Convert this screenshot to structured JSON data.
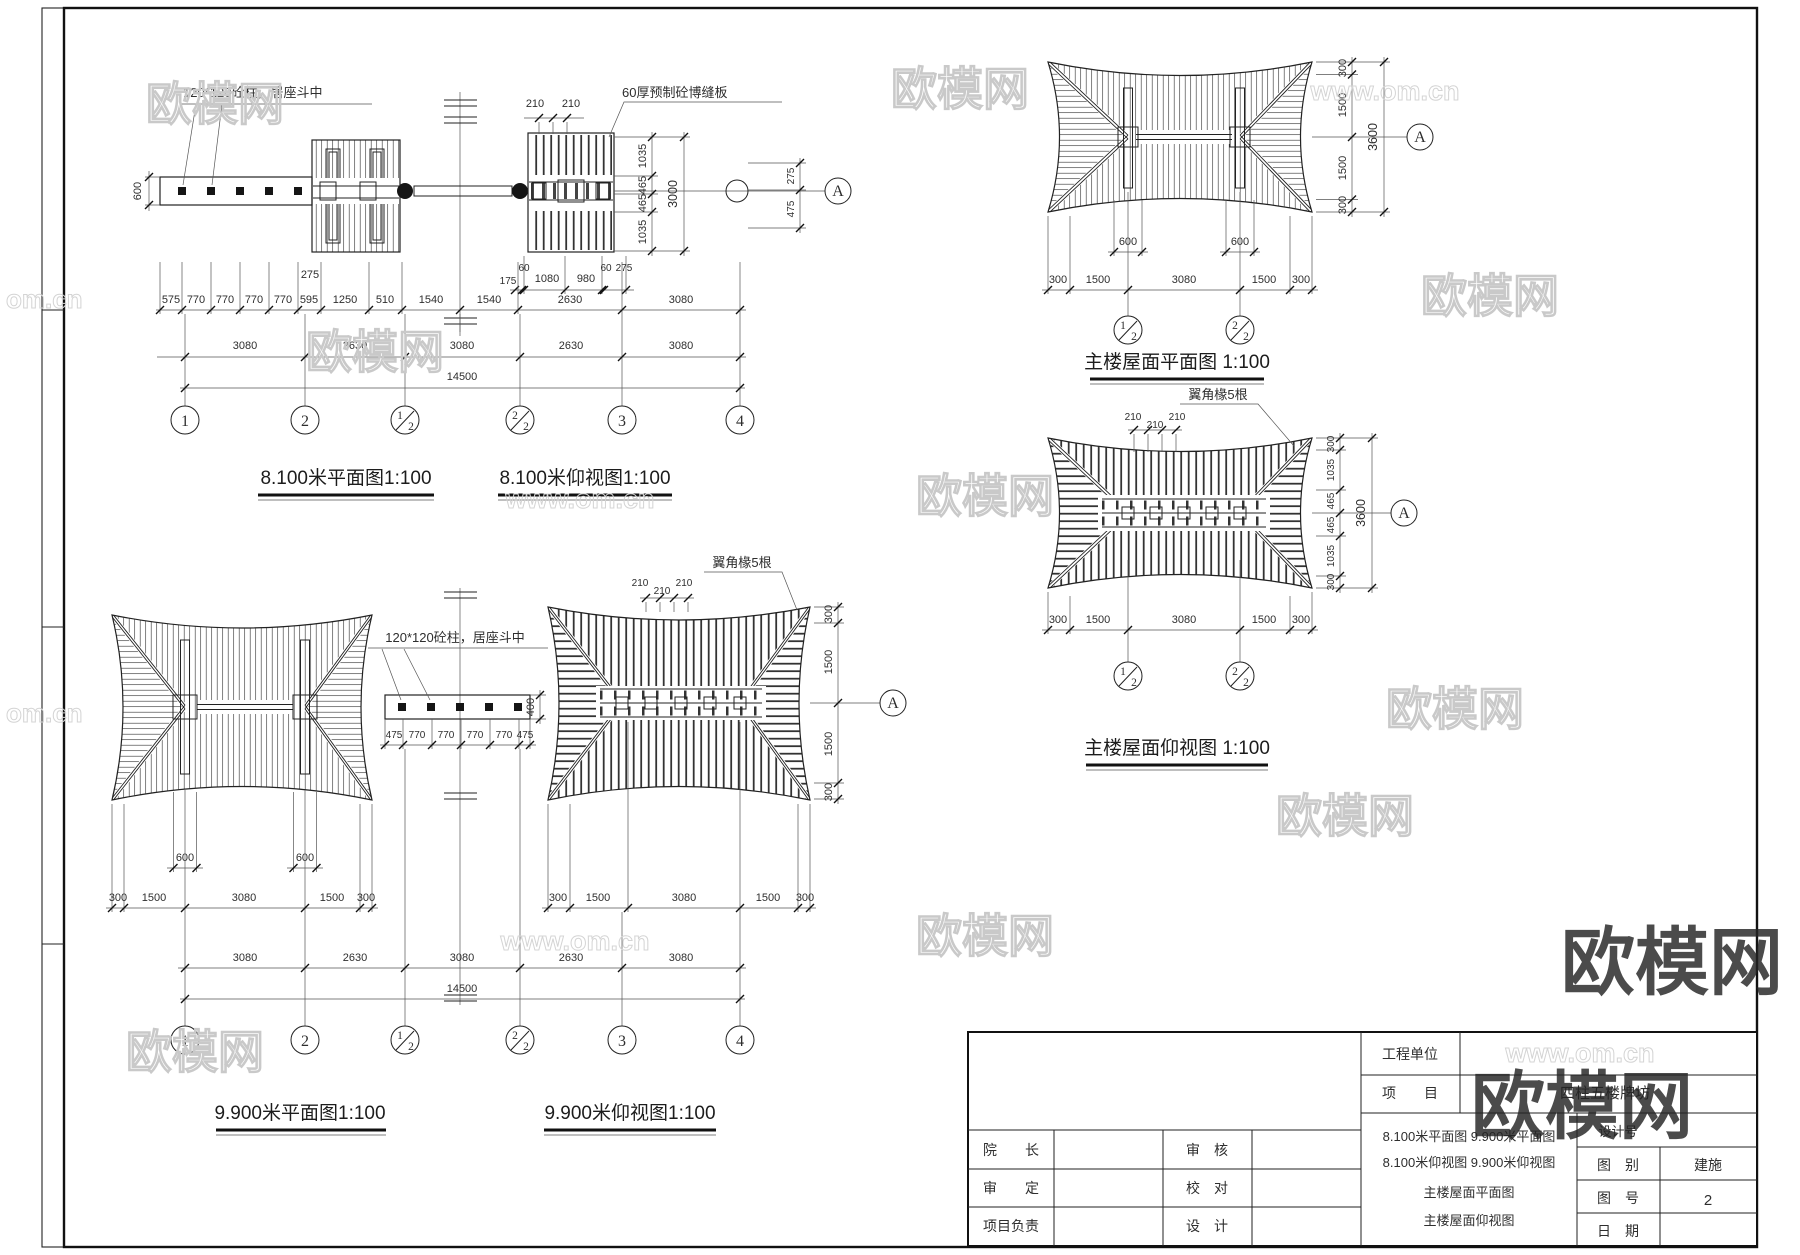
{
  "w": {
    "b": "欧模网",
    "s": "www.om.cn",
    "p": "om.cn"
  },
  "v1": {
    "t1": "8.100米平面图1:100",
    "t2": "8.100米仰视图1:100",
    "lc": "120*120砼柱，居座斗中",
    "lb": "60厚预制砼博缝板",
    "d600": "600",
    "d210": [
      "210",
      "210"
    ],
    "d275": "275",
    "sub": [
      "175",
      "60",
      "1080",
      "980",
      "60",
      "275"
    ],
    "r1": [
      "575",
      "770",
      "770",
      "770",
      "770",
      "595",
      "1250",
      "510",
      "1540",
      "1540",
      "2630",
      "3080"
    ],
    "r2": [
      "3080",
      "2630",
      "3080",
      "2630",
      "3080"
    ],
    "tot": "14500",
    "vr": [
      "1035",
      "465",
      "465",
      "1035"
    ],
    "vrt": "3000",
    "ve": [
      "275",
      "475"
    ],
    "A": "A",
    "g": [
      {
        "l": "1"
      },
      {
        "l": "2"
      },
      {
        "n": "1",
        "d": "2"
      },
      {
        "n": "2",
        "d": "2"
      },
      {
        "l": "3"
      },
      {
        "l": "4"
      }
    ]
  },
  "v2": {
    "t": "主楼屋面平面图 1:100",
    "d600": [
      "600",
      "600"
    ],
    "b": [
      "300",
      "1500",
      "3080",
      "1500",
      "300"
    ],
    "r": [
      "300",
      "1500",
      "1500",
      "300"
    ],
    "rt": "3600",
    "A": "A",
    "g": [
      {
        "n": "1",
        "d": "2"
      },
      {
        "n": "2",
        "d": "2"
      }
    ]
  },
  "v4": {
    "t": "主楼屋面仰视图 1:100",
    "lr": "翼角椽5根",
    "d210": [
      "210",
      "210",
      "210"
    ],
    "b": [
      "300",
      "1500",
      "3080",
      "1500",
      "300"
    ],
    "r": [
      "300",
      "1035",
      "465",
      "465",
      "1035",
      "300"
    ],
    "rt": "3600",
    "A": "A",
    "g": [
      {
        "n": "1",
        "d": "2"
      },
      {
        "n": "2",
        "d": "2"
      }
    ]
  },
  "v3": {
    "t1": "9.900米平面图1:100",
    "t2": "9.900米仰视图1:100",
    "lc": "120*120砼柱，居座斗中",
    "lr": "翼角椽5根",
    "d600": [
      "600",
      "600"
    ],
    "bl": [
      "300",
      "1500",
      "3080",
      "1500",
      "300"
    ],
    "br": [
      "300",
      "1500",
      "3080",
      "1500",
      "300"
    ],
    "beam": [
      "475",
      "770",
      "770",
      "770",
      "770",
      "475"
    ],
    "d400": "400",
    "d210": [
      "210",
      "210",
      "210"
    ],
    "r": [
      "300",
      "1500",
      "1500",
      "300"
    ],
    "r2": [
      "3080",
      "2630",
      "3080",
      "2630",
      "3080"
    ],
    "tot": "14500",
    "A": "A",
    "g": [
      {
        "l": "1"
      },
      {
        "l": "2"
      },
      {
        "n": "1",
        "d": "2"
      },
      {
        "n": "2",
        "d": "2"
      },
      {
        "l": "3"
      },
      {
        "l": "4"
      }
    ]
  },
  "tb": {
    "unit_label": "工程单位",
    "unit_value": "",
    "project_label": "项　　目",
    "project_value": "四柱五楼牌坊",
    "rows_left": [
      {
        "label": "院　　长"
      },
      {
        "label": "审　　定"
      },
      {
        "label": "项目负责"
      }
    ],
    "rows_mid": [
      {
        "label": "审　核"
      },
      {
        "label": "校　对"
      },
      {
        "label": "设　计"
      }
    ],
    "drawings": [
      "8.100米平面图 9.900米平面图",
      "8.100米仰视图 9.900米仰视图",
      "主楼屋面平面图",
      "主楼屋面仰视图"
    ],
    "design_no_label": "设计号",
    "category_label": "图　别",
    "category_value": "建施",
    "sheet_label": "图　号",
    "sheet_value": "2",
    "date_label": "日　期"
  }
}
